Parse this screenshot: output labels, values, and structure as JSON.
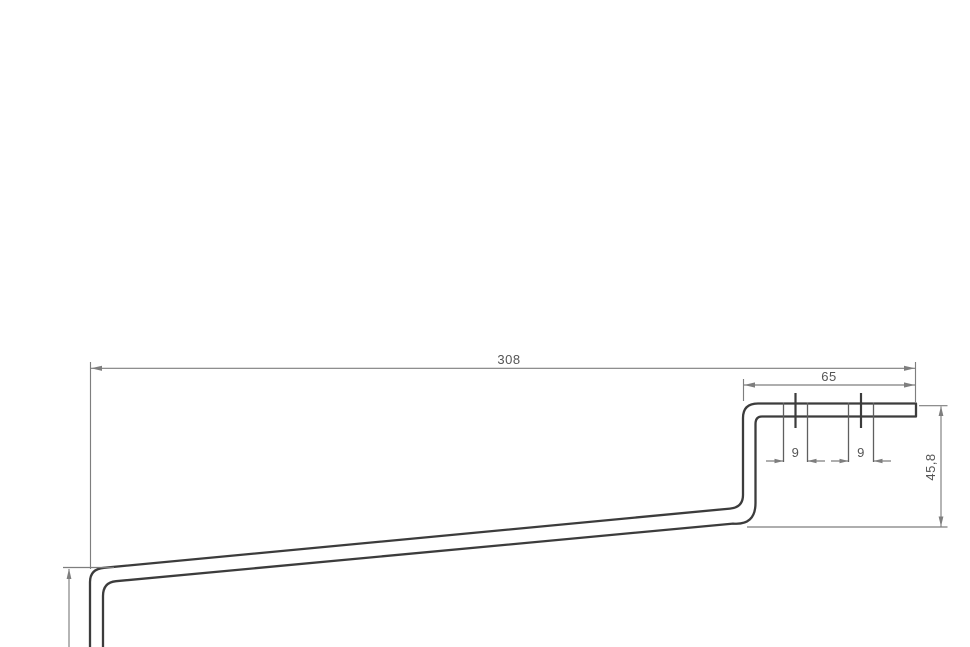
{
  "drawing": {
    "kind": "technical-drawing-side-profile",
    "colors": {
      "background": "#ffffff",
      "part_outline": "#3c3c3c",
      "dimension_lines": "#7e7e7e",
      "dimension_text": "#555555"
    },
    "dimensions": {
      "overall_length": "308",
      "flange_length": "65",
      "hole1_width": "9",
      "hole2_width": "9",
      "flange_drop_height": "45,8"
    }
  }
}
